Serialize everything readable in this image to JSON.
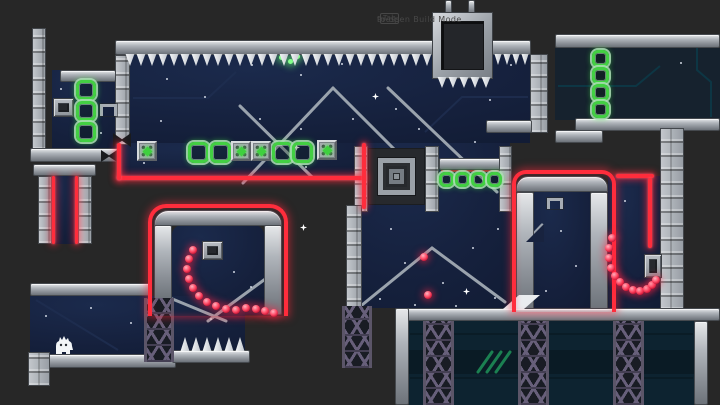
{
  "hud": {
    "hint_prefix": "Press",
    "hint_key": "Tab",
    "hint_suffix": "to open Build Mode"
  },
  "colors": {
    "background": "#272727",
    "room_navy": "#15203c",
    "room_slate": "#16222e",
    "room_teal": "#0d2330",
    "laser_red": "#ff2d3c",
    "ring_green": "#43cf43",
    "orb_red": "#ff4d68",
    "metal_light": "#e6e8ea",
    "metal_dark": "#6d737a",
    "truss_purple": "#675f7a",
    "spike_white": "#f6f8fa",
    "hatch_green": "#23a468"
  },
  "player": {
    "label": "player-character",
    "x": 52,
    "y": 334
  },
  "level": {
    "spike_strips": [
      {
        "name": "ceiling-spikes-left",
        "x": 125,
        "y": 54,
        "count": 28,
        "w": 11,
        "h": 12,
        "dir": "down"
      },
      {
        "name": "ceiling-spikes-right",
        "x": 494,
        "y": 54,
        "count": 4,
        "w": 9,
        "h": 11,
        "dir": "down"
      },
      {
        "name": "crusher-spikes",
        "x": 437,
        "y": 77,
        "count": 5,
        "w": 11,
        "h": 11,
        "dir": "down"
      },
      {
        "name": "floor-spikes",
        "x": 180,
        "y": 337,
        "count": 6,
        "w": 11,
        "h": 14,
        "dir": "up"
      }
    ],
    "ring_groups": [
      {
        "name": "top-room-ring-row",
        "size": 21,
        "points": [
          [
            188,
            142
          ],
          [
            210,
            142
          ],
          [
            272,
            142
          ],
          [
            292,
            142
          ]
        ]
      },
      {
        "name": "alcove-ring-chain",
        "size": 20,
        "points": [
          [
            76,
            80
          ],
          [
            76,
            101
          ],
          [
            76,
            122
          ]
        ]
      },
      {
        "name": "right-room-ring-chain",
        "size": 17,
        "points": [
          [
            592,
            50
          ],
          [
            592,
            67
          ],
          [
            592,
            84
          ],
          [
            592,
            101
          ]
        ]
      },
      {
        "name": "mid-ring-row",
        "size": 15,
        "points": [
          [
            439,
            172
          ],
          [
            455,
            172
          ],
          [
            471,
            172
          ],
          [
            487,
            172
          ]
        ]
      }
    ],
    "crystal_blocks": [
      [
        137,
        141
      ],
      [
        231,
        141
      ],
      [
        251,
        141
      ],
      [
        317,
        140
      ]
    ],
    "orb_arcs": [
      {
        "name": "left-orb-arc",
        "points": [
          [
            193,
            250
          ],
          [
            189,
            259
          ],
          [
            187,
            269
          ],
          [
            189,
            279
          ],
          [
            193,
            288
          ],
          [
            199,
            296
          ],
          [
            207,
            302
          ],
          [
            216,
            306
          ],
          [
            226,
            309
          ],
          [
            236,
            310
          ],
          [
            246,
            308
          ],
          [
            256,
            309
          ],
          [
            265,
            311
          ],
          [
            274,
            313
          ]
        ]
      },
      {
        "name": "right-orb-arc",
        "points": [
          [
            612,
            238
          ],
          [
            609,
            248
          ],
          [
            609,
            258
          ],
          [
            611,
            268
          ],
          [
            615,
            276
          ],
          [
            620,
            282
          ],
          [
            626,
            287
          ],
          [
            633,
            290
          ],
          [
            640,
            291
          ],
          [
            647,
            289
          ],
          [
            652,
            285
          ],
          [
            656,
            280
          ]
        ]
      }
    ],
    "single_orbs": [
      [
        424,
        257
      ],
      [
        428,
        295
      ]
    ],
    "stars": [
      [
        166,
        78
      ],
      [
        204,
        96
      ],
      [
        251,
        64
      ],
      [
        300,
        74
      ],
      [
        341,
        63
      ],
      [
        300,
        128
      ],
      [
        259,
        118
      ],
      [
        160,
        120
      ],
      [
        352,
        118
      ],
      [
        395,
        108
      ],
      [
        452,
        74
      ],
      [
        489,
        99
      ],
      [
        510,
        64
      ],
      [
        418,
        128
      ],
      [
        474,
        141
      ],
      [
        143,
        162
      ],
      [
        305,
        166
      ],
      [
        381,
        160
      ],
      [
        390,
        228
      ],
      [
        404,
        262
      ],
      [
        442,
        282
      ],
      [
        472,
        247
      ],
      [
        497,
        228
      ],
      [
        455,
        305
      ],
      [
        379,
        298
      ],
      [
        494,
        297
      ],
      [
        414,
        304
      ],
      [
        233,
        271
      ],
      [
        250,
        286
      ],
      [
        60,
        88
      ],
      [
        100,
        132
      ],
      [
        45,
        315
      ],
      [
        90,
        307
      ],
      [
        130,
        322
      ],
      [
        210,
        318
      ],
      [
        560,
        230
      ],
      [
        575,
        265
      ],
      [
        545,
        290
      ],
      [
        624,
        200
      ],
      [
        680,
        62
      ]
    ],
    "sparkles": [
      [
        296,
        147
      ],
      [
        375,
        96
      ],
      [
        466,
        291
      ],
      [
        303,
        227
      ]
    ],
    "green_glows": [
      [
        281,
        57
      ],
      [
        290,
        61
      ],
      [
        297,
        56
      ]
    ],
    "trusses": [
      [
        144,
        298,
        30,
        64
      ],
      [
        342,
        306,
        30,
        62
      ],
      [
        423,
        321,
        31,
        84
      ],
      [
        518,
        321,
        31,
        84
      ],
      [
        613,
        321,
        31,
        84
      ]
    ]
  }
}
